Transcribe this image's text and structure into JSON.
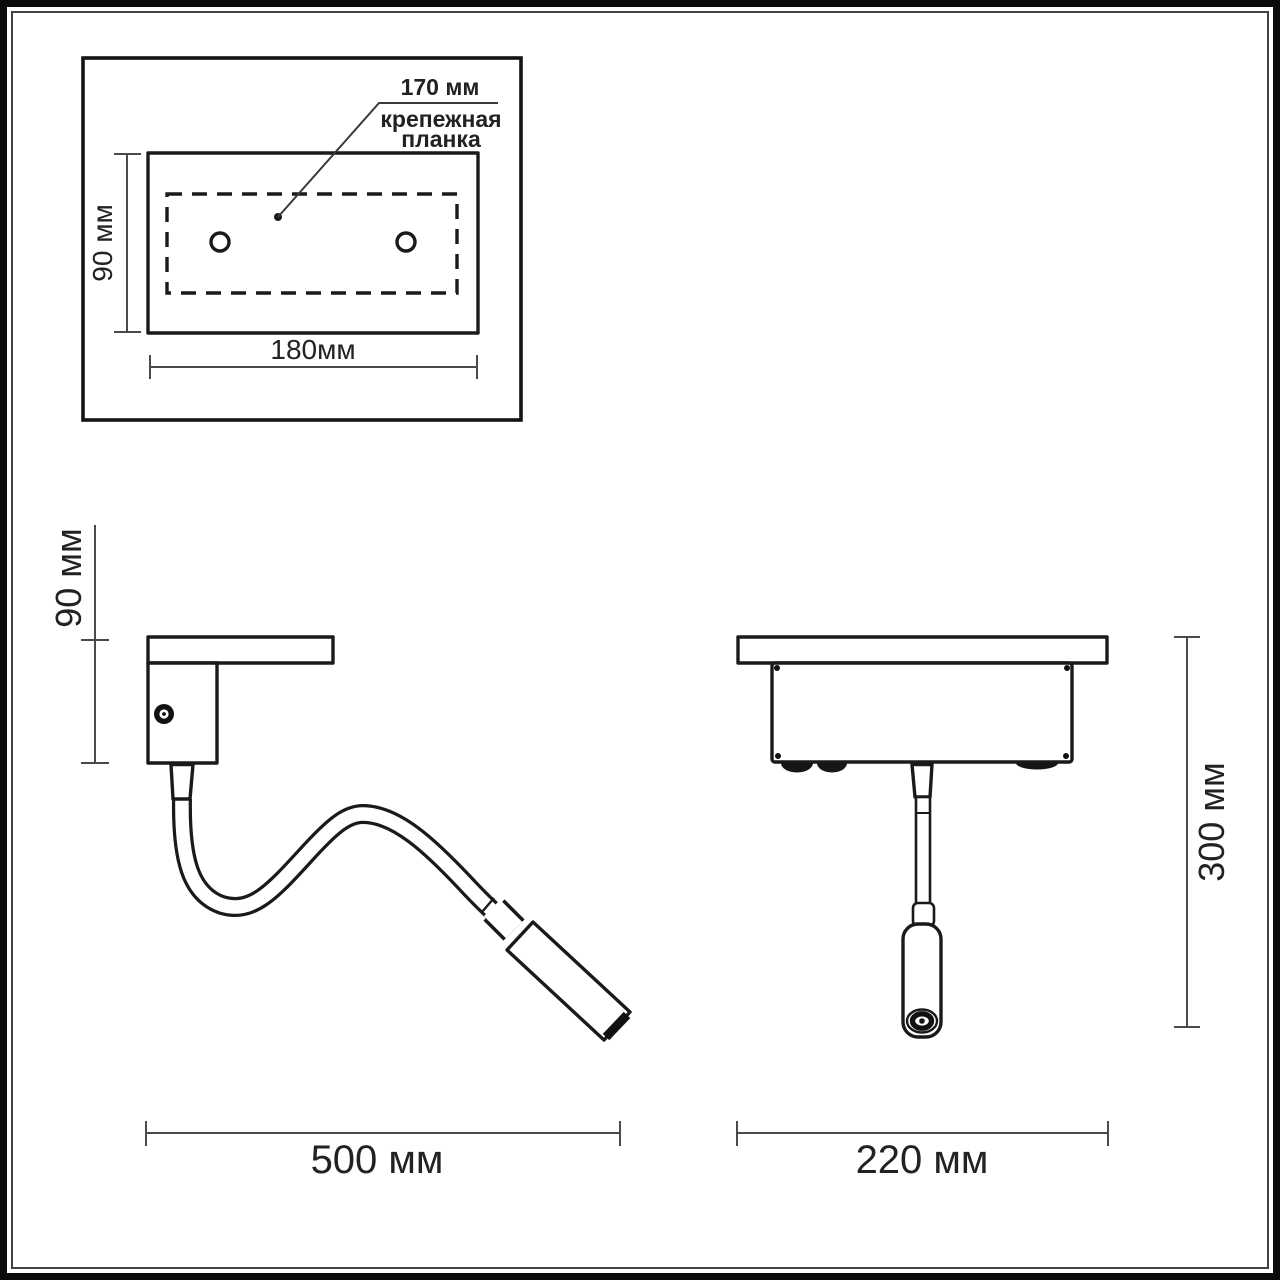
{
  "figure": {
    "inset": {
      "callout_value": "170 мм",
      "callout_label": [
        "крепежная",
        "планка"
      ],
      "height_label": "90 мм",
      "width_label": "180мм"
    },
    "side_view": {
      "height_label": "90 мм",
      "width_label": "500 мм"
    },
    "front_view": {
      "height_label": "300 мм",
      "width_label": "220 мм"
    }
  },
  "colors": {
    "line": "#1a1a1a",
    "dimension_line": "#4a4a4a",
    "frame": "#0b0b0b",
    "background": "#ffffff"
  }
}
